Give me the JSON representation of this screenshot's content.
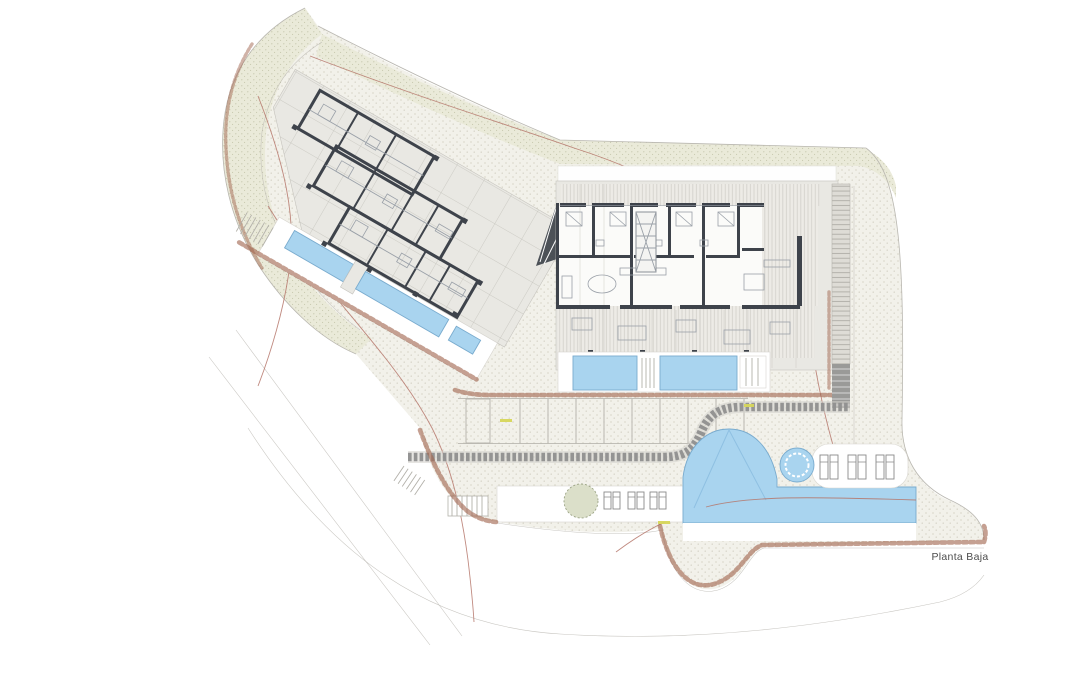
{
  "plan": {
    "label": "Planta Baja",
    "colors": {
      "page_bg": "#ffffff",
      "ground": "#f2f1ea",
      "ground_dot": "#ccc9ba",
      "green_band": "#eaead9",
      "green_dot": "#c2c3a8",
      "hatch_bg": "#edebe6",
      "hatch_line": "#d3d1cb",
      "rung_bg": "#dedcd6",
      "rung_line": "#b2b0a9",
      "plate": "#e9e8e3",
      "plate_line": "#c6c4be",
      "room_bg": "#fbfbf9",
      "wall": "#3e434b",
      "wall_thin": "#9aa0a8",
      "pool": "#a9d4ef",
      "pool_edge": "#79abce",
      "pool_line": "#8fc0e2",
      "rock": "#a2664f",
      "contour": "#b5766a",
      "walkway": "#8f8f8f",
      "walkway_under": "#d2d0ca",
      "deck": "#ffffff",
      "deck_line": "#d8d6d0",
      "lounger": "#8a8a8a",
      "tree": "#dbdfc9",
      "tree_edge": "#9aa284",
      "boundary": "#b9b7b0",
      "step": "#b3b1aa",
      "dimension": "#d6d65a",
      "label_text": "#4c4c4c"
    }
  }
}
